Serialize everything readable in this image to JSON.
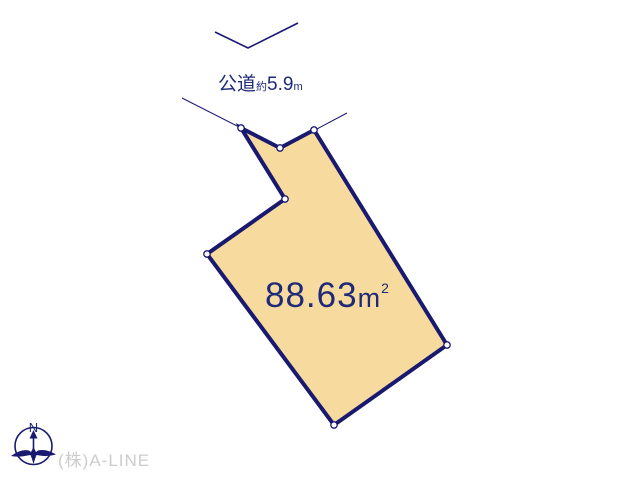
{
  "diagram": {
    "road": {
      "label": "公道",
      "approx_prefix": "約",
      "width_value": "5.9",
      "width_unit": "m"
    },
    "parcel": {
      "area_value": "88.63",
      "area_unit_base": "m",
      "area_unit_exponent": "2"
    },
    "compass": {
      "north_label": "N"
    },
    "watermark": {
      "company": "(株)A-LINE"
    }
  },
  "colors": {
    "line_navy": "#191970",
    "text_navy": "#1e2a78",
    "parcel_fill": "#f7da9e",
    "watermark_gray": "#cccccc",
    "background": "#ffffff"
  }
}
